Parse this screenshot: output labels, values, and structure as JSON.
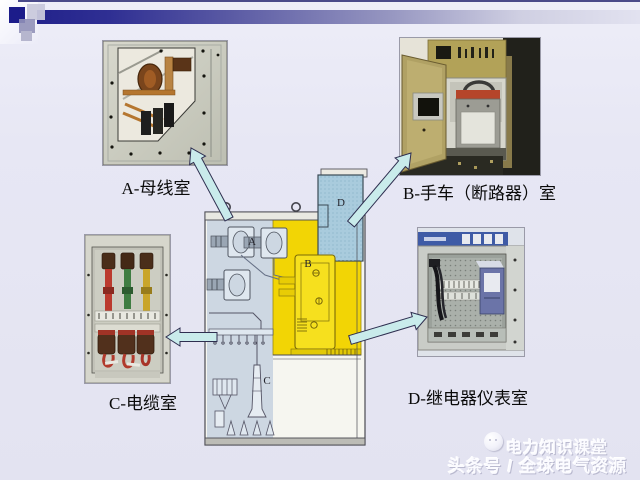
{
  "slide": {
    "background_color": "#e7e7f4",
    "header": {
      "accent_color": "#1c1c8a",
      "bar_gradient_start": "#23238c",
      "bar_gradient_end": "#e2e2f0"
    },
    "callouts": {
      "a": {
        "label": "A-母线室"
      },
      "b": {
        "label": "B-手车（断路器）室"
      },
      "c": {
        "label": "C-电缆室"
      },
      "d": {
        "label": "D-继电器仪表室"
      }
    },
    "diagram": {
      "letters": {
        "a": "A",
        "b": "B",
        "c": "C",
        "d": "D"
      },
      "colors": {
        "breaker_zone_yellow": "#f2d505",
        "relay_box_blue": "#a9cbdd",
        "busbar_cable_zone_gray": "#cdd7e2",
        "arrow_fill": "#c9ebeb",
        "arrow_stroke": "#2e2e50"
      }
    },
    "watermark": {
      "line1": "电力知识课堂",
      "line2": "头条号 / 全球电气资源"
    }
  }
}
